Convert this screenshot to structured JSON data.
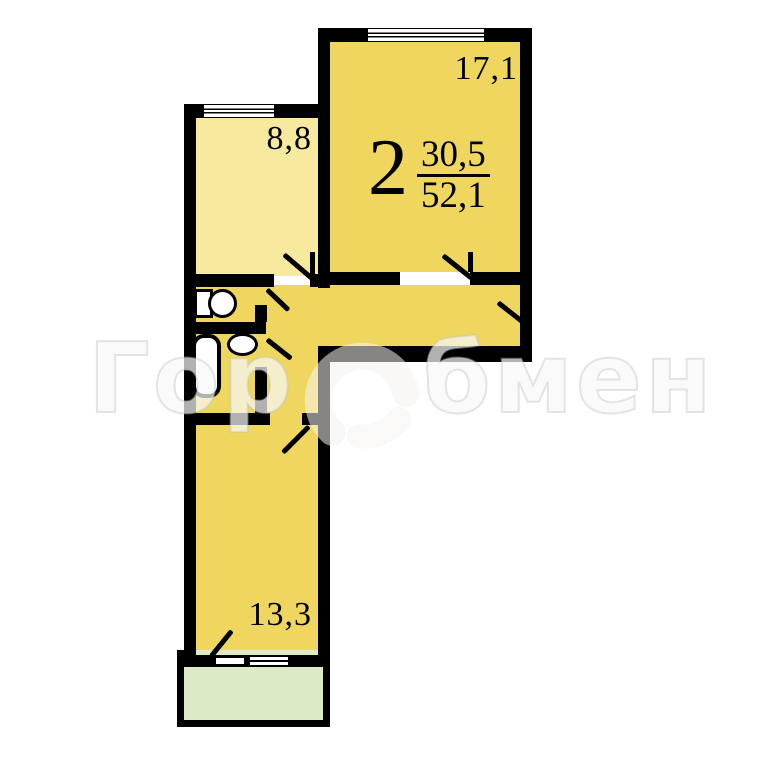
{
  "meta": {
    "kind": "apartment-floor-plan",
    "description": "2-room apartment plan with watermark"
  },
  "apartment_label": {
    "rooms_count": "2",
    "living_area": "30,5",
    "total_area": "52,1"
  },
  "rooms": {
    "living": {
      "name": "living-room",
      "area": "17,1"
    },
    "kitchen": {
      "name": "kitchen",
      "area": "8,8"
    },
    "bedroom": {
      "name": "bedroom",
      "area": "13,3"
    }
  },
  "watermark": {
    "full": "ГорОбмен",
    "prefix": "Гор",
    "suffix": "бмен"
  },
  "colors": {
    "room_yellow": "#EFD75F",
    "kitchen_pale": "#F7EA9F",
    "balcony_green": "#DCEBC5",
    "wall": "#000000",
    "background": "#FFFFFF",
    "watermark": "rgba(255,255,255,0.62)"
  }
}
